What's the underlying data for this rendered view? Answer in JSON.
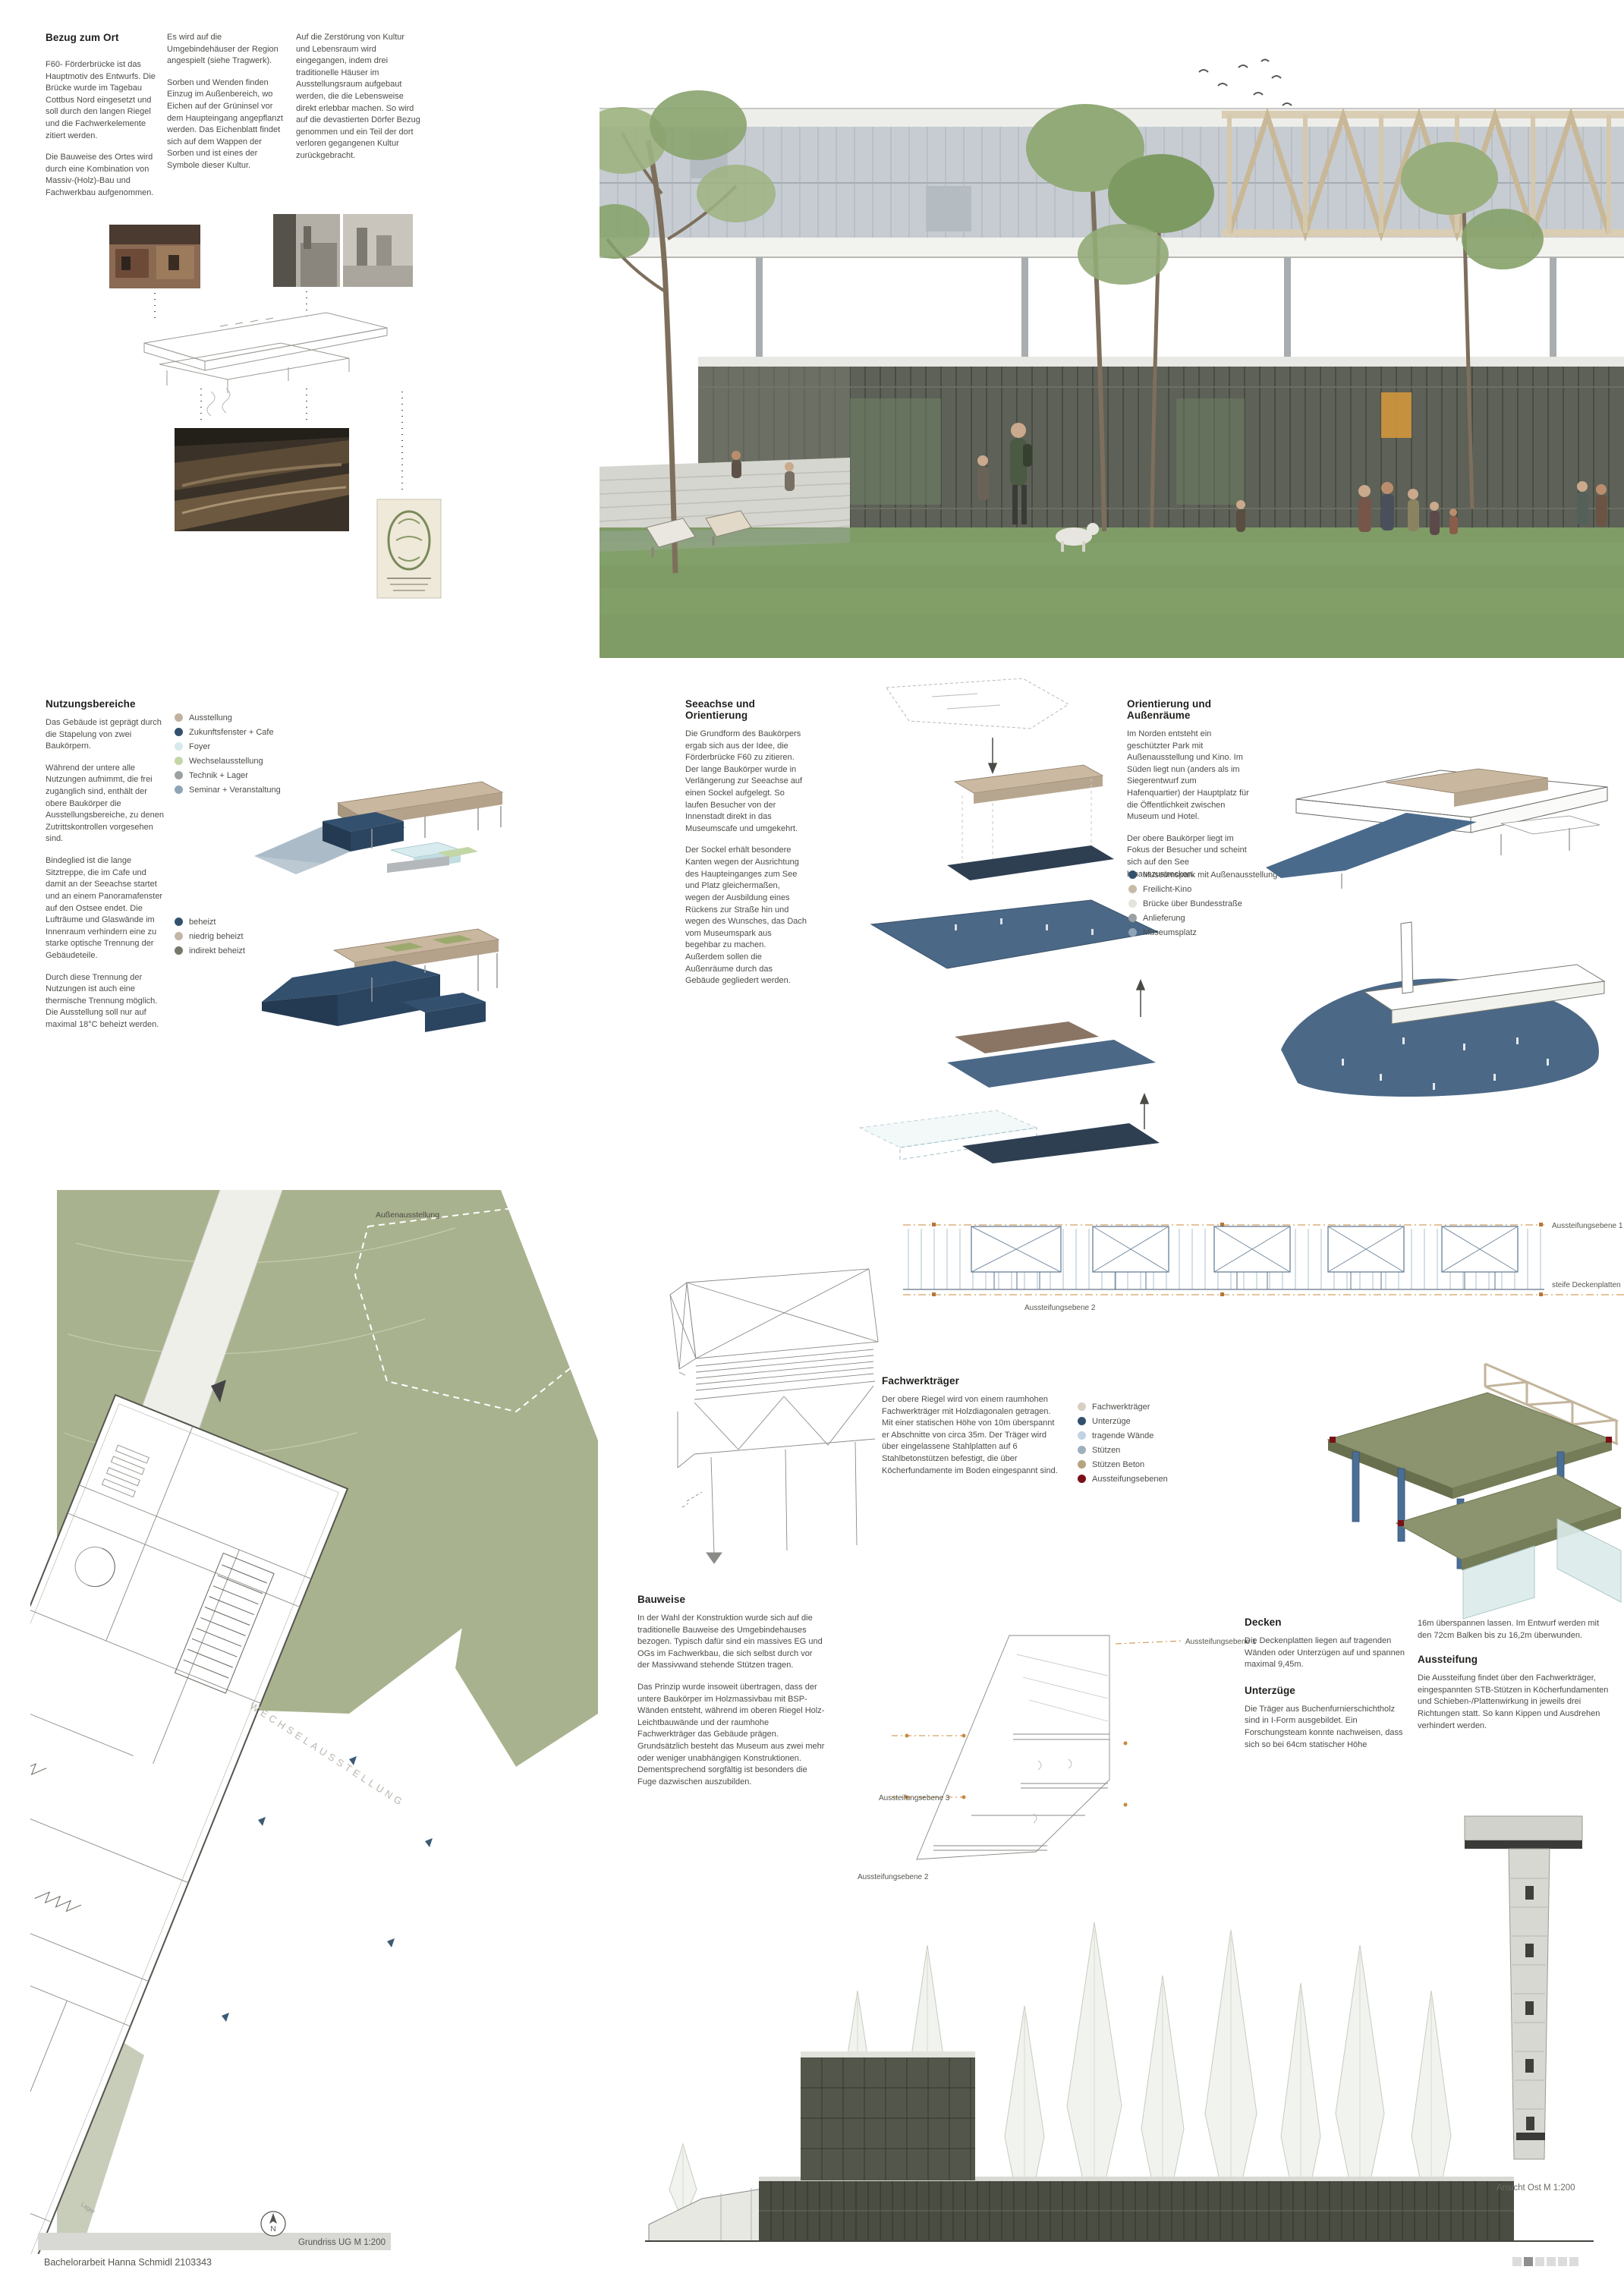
{
  "footer": "Bachelorarbeit Hanna Schmidl 2103343",
  "colors": {
    "lawn": "#7f9b66",
    "plan_green": "#a9b28e",
    "navy": "#33506e",
    "steel_blue": "#4b6886",
    "tan": "#c9b7a0",
    "caption_band": "#d8d8d4",
    "aussteifung_red": "#7a1016",
    "page_square_active": "#8f8f8f",
    "page_square": "#dcdcdc"
  },
  "bezug": {
    "title": "Bezug zum Ort",
    "col1": [
      "F60- Förderbrücke ist das Hauptmotiv des Entwurfs. Die Brücke wurde im Tagebau Cottbus Nord eingesetzt und soll durch den langen Riegel und die Fachwerkelemente zitiert werden.",
      "Die Bauweise des Ortes wird durch eine Kombination von Massiv-(Holz)-Bau und Fachwerkbau aufgenommen."
    ],
    "col2": [
      "Es wird auf die Umgebindehäuser der Region angespielt (siehe Tragwerk).",
      "Sorben und Wenden finden Einzug im Außenbereich, wo Eichen auf der Grüninsel vor dem Haupteingang angepflanzt werden. Das Eichenblatt findet sich auf dem Wappen der Sorben und ist eines der Symbole dieser Kultur."
    ],
    "col3": [
      "Auf die Zerstörung von Kultur und Lebensraum wird eingegangen, indem drei traditionelle Häuser im Ausstellungsraum aufgebaut werden, die die Lebensweise direkt erlebbar machen. So wird auf die devastierten Dörfer Bezug genommen und ein Teil der dort verloren gegangenen Kultur zurückgebracht."
    ]
  },
  "nutzung": {
    "title": "Nutzungsbereiche",
    "paragraphs": [
      "Das Gebäude ist geprägt durch die Stapelung von zwei Baukörpern.",
      "Während der untere alle Nutzungen aufnimmt, die frei zugänglich sind, enthält der obere Baukörper die Ausstellungsbereiche, zu denen Zutrittskontrollen vorgesehen sind.",
      "Bindeglied ist die lange Sitztreppe, die im Cafe und damit an der Seeachse startet und an einem Panoramafenster auf den Ostsee endet. Die Lufträume und Glaswände im Innenraum verhindern eine zu starke optische Trennung der Gebäudeteile.",
      "Durch diese Trennung der Nutzungen ist auch eine thermische Trennung möglich. Die Ausstellung soll nur auf maximal 18°C beheizt werden."
    ],
    "legend": [
      {
        "label": "Ausstellung",
        "color": "#c0b2a0"
      },
      {
        "label": "Zukunftsfenster + Cafe",
        "color": "#33506e"
      },
      {
        "label": "Foyer",
        "color": "#d8e9ee"
      },
      {
        "label": "Wechselausstellung",
        "color": "#c3d6a6"
      },
      {
        "label": "Technik + Lager",
        "color": "#9ba0a2"
      },
      {
        "label": "Seminar + Veranstaltung",
        "color": "#8fa5b5"
      }
    ],
    "legend2": [
      {
        "label": "beheizt",
        "color": "#33506e"
      },
      {
        "label": "niedrig beheizt",
        "color": "#c4b6a6"
      },
      {
        "label": "indirekt beheizt",
        "color": "#75796b"
      }
    ]
  },
  "seeachse": {
    "title": "Seeachse und Orientierung",
    "paragraphs": [
      "Die Grundform des Baukörpers ergab sich aus der Idee, die Förderbrücke F60 zu zitieren. Der lange Baukörper wurde in Verlängerung zur Seeachse auf einen Sockel aufgelegt. So laufen Besucher von der Innenstadt direkt in das Museumscafe und umgekehrt.",
      "Der Sockel erhält besondere Kanten wegen der Ausrichtung des Haupteinganges zum See und Platz gleichermaßen, wegen der Ausbildung eines Rückens zur Straße hin und wegen des Wunsches, das Dach vom Museumspark aus begehbar zu machen. Außerdem sollen die Außenräume durch das Gebäude gegliedert werden."
    ]
  },
  "orientierung": {
    "title": "Orientierung und Außenräume",
    "paragraphs": [
      "Im Norden entsteht ein geschützter Park mit Außenausstellung und Kino. Im Süden liegt nun (anders als im Siegerentwurf zum Hafenquartier) der Hauptplatz für die Öffentlichkeit zwischen Museum und Hotel.",
      "Der obere Baukörper liegt im Fokus der Besucher und scheint sich auf den See hinauszustrecken."
    ],
    "legend": [
      {
        "label": "Museumspark mit Außenausstellung",
        "color": "#33506e"
      },
      {
        "label": "Freilicht-Kino",
        "color": "#c9baa8"
      },
      {
        "label": "Brücke über Bundesstraße",
        "color": "#e4e4df"
      },
      {
        "label": "Anlieferung",
        "color": "#9ba0a2"
      },
      {
        "label": "Museumsplatz",
        "color": "#8fa5b5"
      }
    ]
  },
  "fachwerk": {
    "title": "Fachwerkträger",
    "text": "Der obere Riegel wird von einem raumhohen Fachwerkträger mit Holzdiagonalen getragen. Mit einer statischen Höhe von 10m überspannt er Abschnitte von circa 35m. Der Träger wird über eingelassene Stahlplatten auf 6 Stahlbetonstützen befestigt, die über Köcherfundamente im Boden eingespannt sind.",
    "legend": [
      {
        "label": "Fachwerkträger",
        "color": "#d8cfc2"
      },
      {
        "label": "Unterzüge",
        "color": "#33506e"
      },
      {
        "label": "tragende Wände",
        "color": "#c3d2e2"
      },
      {
        "label": "Stützen",
        "color": "#9fb0bd"
      },
      {
        "label": "Stützen Beton",
        "color": "#b5a47e"
      },
      {
        "label": "Aussteifungsebenen",
        "color": "#7a1016"
      }
    ]
  },
  "struktur_labels": {
    "e1": "Aussteifungsebene 1",
    "e2": "Aussteifungsebene 2",
    "e3": "Aussteifungsebene 3",
    "deckenplatten": "steife Deckenplatten"
  },
  "bauweise": {
    "title": "Bauweise",
    "paragraphs": [
      "In der Wahl der Konstruktion wurde sich auf die traditionelle Bauweise des Umgebindehauses bezogen. Typisch dafür sind ein massives EG und OGs im Fachwerkbau, die sich selbst durch vor der Massivwand stehende Stützen tragen.",
      "Das Prinzip wurde insoweit übertragen, dass der untere Baukörper im Holzmassivbau mit BSP-Wänden entsteht, während im oberen Riegel Holz-Leichtbauwände und der raumhohe Fachwerkträger das Gebäude prägen. Grundsätzlich besteht das Museum aus zwei mehr oder weniger unabhängigen Konstruktionen. Dementsprechend sorgfältig ist besonders die Fuge dazwischen auszubilden."
    ]
  },
  "decken": {
    "title": "Decken",
    "text": "Die Deckenplatten liegen auf tragenden Wänden oder Unterzügen auf und spannen maximal 9,45m."
  },
  "unterzuege": {
    "title": "Unterzüge",
    "text": "Die Träger aus Buchenfurnierschichtholz sind in I-Form ausgebildet. Ein Forschungsteam konnte nachweisen, dass sich so bei 64cm statischer Höhe"
  },
  "spann": {
    "text": "16m überspannen lassen. Im Entwurf werden mit den 72cm Balken bis zu 16,2m überwunden."
  },
  "aussteifung": {
    "title": "Aussteifung",
    "text": "Die Aussteifung findet über den Fachwerkträger, eingespannten STB-Stützen in Köcherfundamenten und Schieben-/Plattenwirkung in jeweils drei Richtungen statt. So kann Kippen und Ausdrehen verhindert werden."
  },
  "plan": {
    "aussen": "Außenausstellung",
    "wechsel": "WECHSELAUSSTELLUNG",
    "lager": "Lager",
    "north": "N",
    "caption": "Grundriss UG M 1:200"
  },
  "ansicht": {
    "caption": "Ansicht Ost M 1:200"
  }
}
